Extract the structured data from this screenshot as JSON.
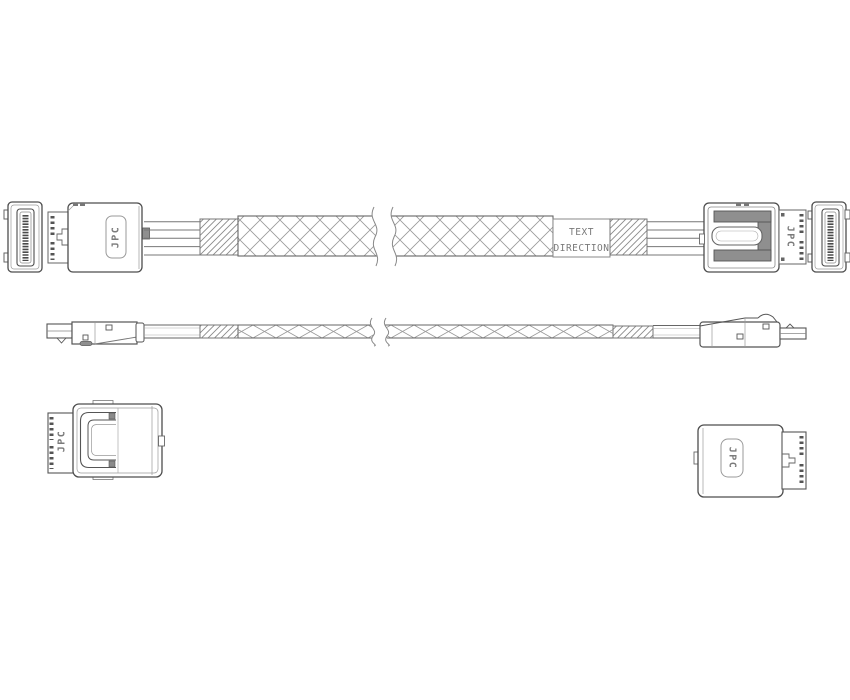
{
  "drawing": {
    "type": "technical-line-drawing",
    "subject": "slim-line cable assembly with latching connectors",
    "background_color": "#ffffff",
    "line_color_main": "#4d4d4d",
    "line_color_light": "#9a9a9a",
    "latch_fill_color": "#8f8f8f",
    "text_color": "#7a7a7a"
  },
  "labels": {
    "brand": "JPC",
    "sleeve_line1": "TEXT",
    "sleeve_line2": "DIRECTION"
  },
  "views": {
    "plan": "cable-assembly-plan-view",
    "side": "cable-assembly-side-view",
    "detail_left": "left-connector-bottom-detail",
    "detail_right": "right-connector-bottom-detail"
  }
}
